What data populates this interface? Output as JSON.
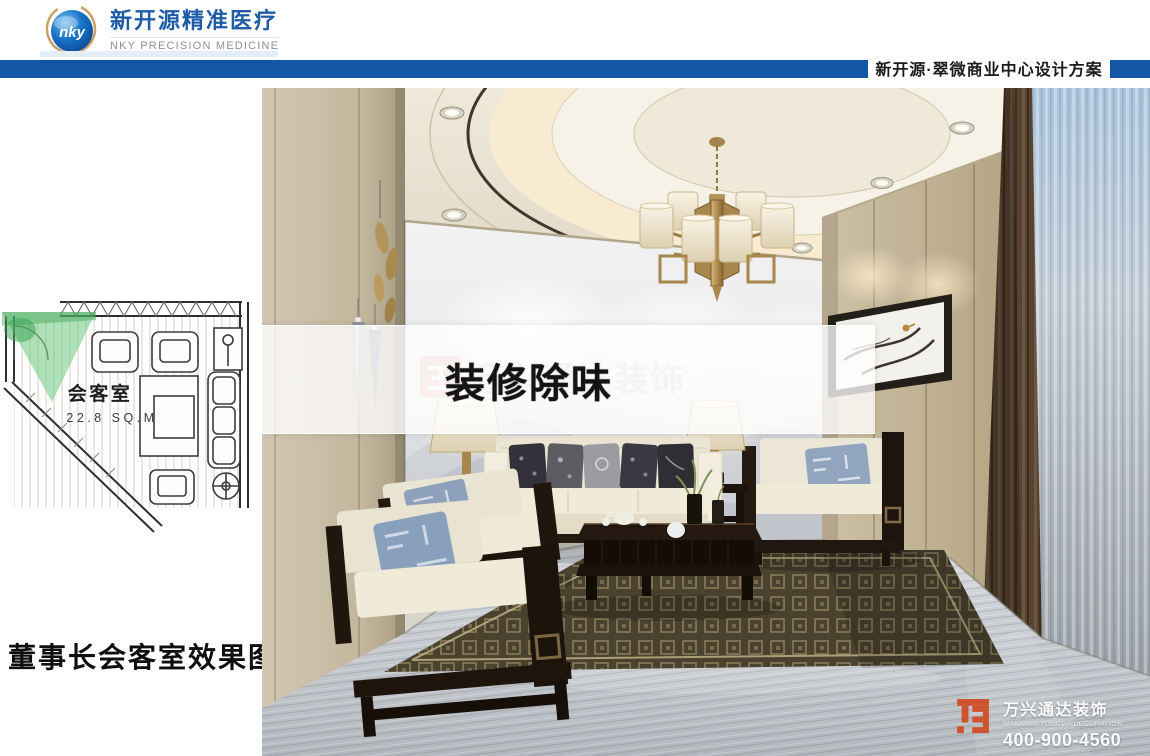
{
  "header": {
    "logo_mark": "nky",
    "brand_cn": "新开源精准医疗",
    "brand_en": "NKY PRECISION MEDICINE",
    "project_title": "新开源·翠微商业中心设计方案"
  },
  "floor_plan": {
    "room_name": "会客室",
    "room_area": "22.8 SQ.M"
  },
  "caption": "董事长会客室效果图",
  "photo": {
    "banner_text": "装修除味",
    "center_watermark": "万兴通达装饰"
  },
  "corner_watermark": {
    "company_cn": "万兴通达装饰",
    "company_en": "WANXING TONGDA DECORATION",
    "phone": "400-900-4560"
  },
  "colors": {
    "bar_blue": "#1256a5",
    "brand_blue": "#1e5ca8",
    "watermark_orange": "#cf4e28",
    "banner_text_color": "#141414"
  }
}
